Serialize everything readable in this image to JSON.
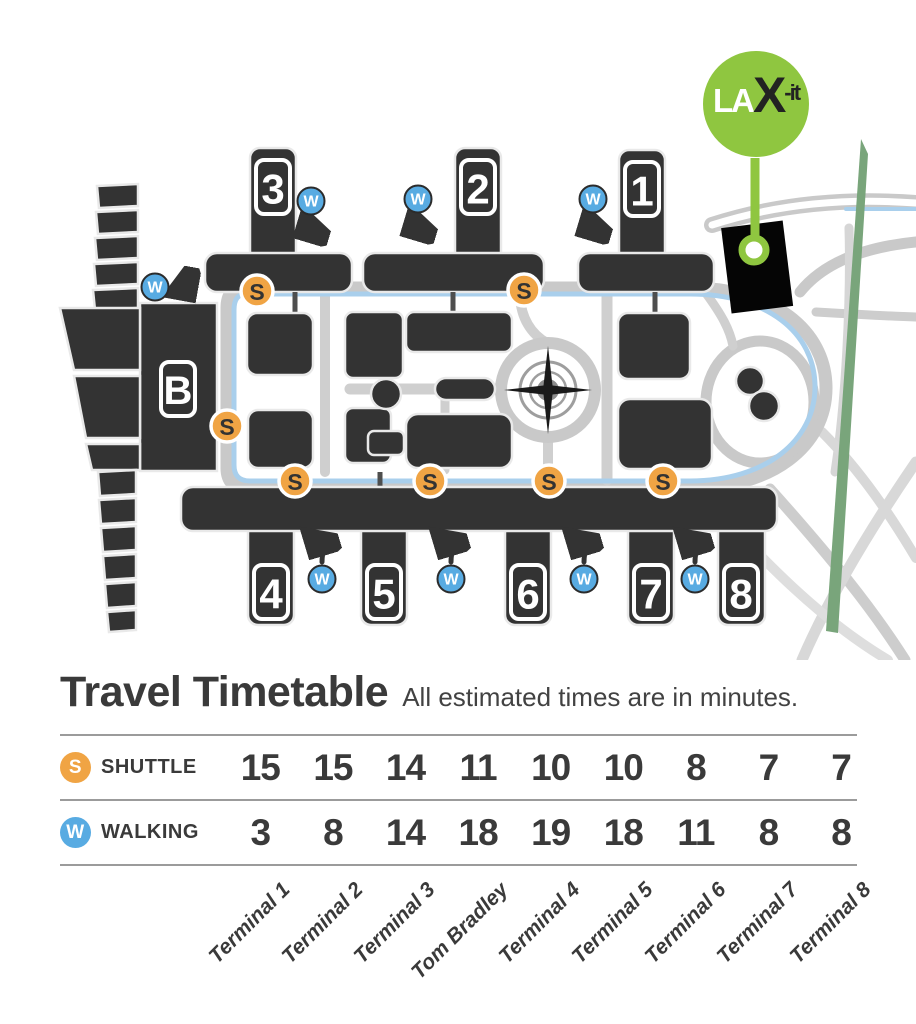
{
  "colors": {
    "terminal_dark": "#333333",
    "road_gray": "#C9C9C9",
    "route_blue": "#A9CFEC",
    "shuttle_orange": "#F0A444",
    "walking_blue": "#58ABE2",
    "laxit_green": "#8FC640",
    "parkway_green": "#79A57B"
  },
  "map": {
    "laxit_logo": {
      "la": "LA",
      "x": "X",
      "it": "-it"
    },
    "stop_letter": "S",
    "walk_letter": "W",
    "badges": {
      "t1": "1",
      "t2": "2",
      "t3": "3",
      "t4": "4",
      "t5": "5",
      "t6": "6",
      "t7": "7",
      "t8": "8",
      "tom_bradley": "B"
    }
  },
  "timetable": {
    "title": "Travel Timetable",
    "subtitle": "All estimated times are in minutes.",
    "rows": [
      {
        "id": "shuttle",
        "icon_letter": "S",
        "label": "SHUTTLE",
        "values": [
          "15",
          "15",
          "14",
          "11",
          "10",
          "10",
          "8",
          "7",
          "7"
        ]
      },
      {
        "id": "walking",
        "icon_letter": "W",
        "label": "WALKING",
        "values": [
          "3",
          "8",
          "14",
          "18",
          "19",
          "18",
          "11",
          "8",
          "8"
        ]
      }
    ],
    "columns": [
      "Terminal 1",
      "Terminal 2",
      "Terminal 3",
      "Tom Bradley",
      "Terminal 4",
      "Terminal 5",
      "Terminal 6",
      "Terminal 7",
      "Terminal 8"
    ]
  },
  "chart_data": {
    "type": "table",
    "title": "Travel Timetable",
    "subtitle": "All estimated times are in minutes.",
    "units": "minutes",
    "columns": [
      "Terminal 1",
      "Terminal 2",
      "Terminal 3",
      "Tom Bradley",
      "Terminal 4",
      "Terminal 5",
      "Terminal 6",
      "Terminal 7",
      "Terminal 8"
    ],
    "series": [
      {
        "name": "SHUTTLE",
        "values": [
          15,
          15,
          14,
          11,
          10,
          10,
          8,
          7,
          7
        ]
      },
      {
        "name": "WALKING",
        "values": [
          3,
          8,
          14,
          18,
          19,
          18,
          11,
          8,
          8
        ]
      }
    ]
  }
}
